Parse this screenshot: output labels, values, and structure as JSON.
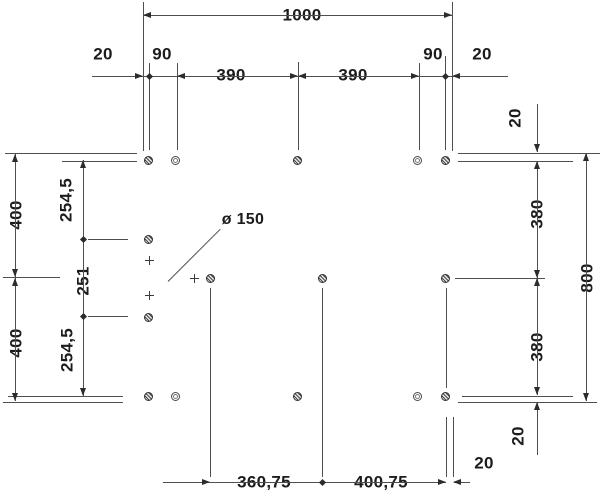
{
  "drawing": {
    "annotation_drain": "ø 150",
    "top": {
      "total": "1000",
      "chain": [
        "20",
        "90",
        "390",
        "390",
        "90",
        "20"
      ]
    },
    "right": {
      "edge_offset_top": "20",
      "chain": [
        "380",
        "380"
      ],
      "total": "800",
      "edge_offset_bottom": "20"
    },
    "left": {
      "halves": [
        "400",
        "400"
      ],
      "hole_chain": [
        "254,5",
        "251",
        "254,5"
      ]
    },
    "bottom": {
      "chain": [
        "360,75",
        "400,75"
      ],
      "edge_offset": "20"
    }
  },
  "colors": {
    "line": "#4f4f4f",
    "marker": "#2c2c2c",
    "text": "#1c1c1c",
    "background": "#ffffff"
  }
}
